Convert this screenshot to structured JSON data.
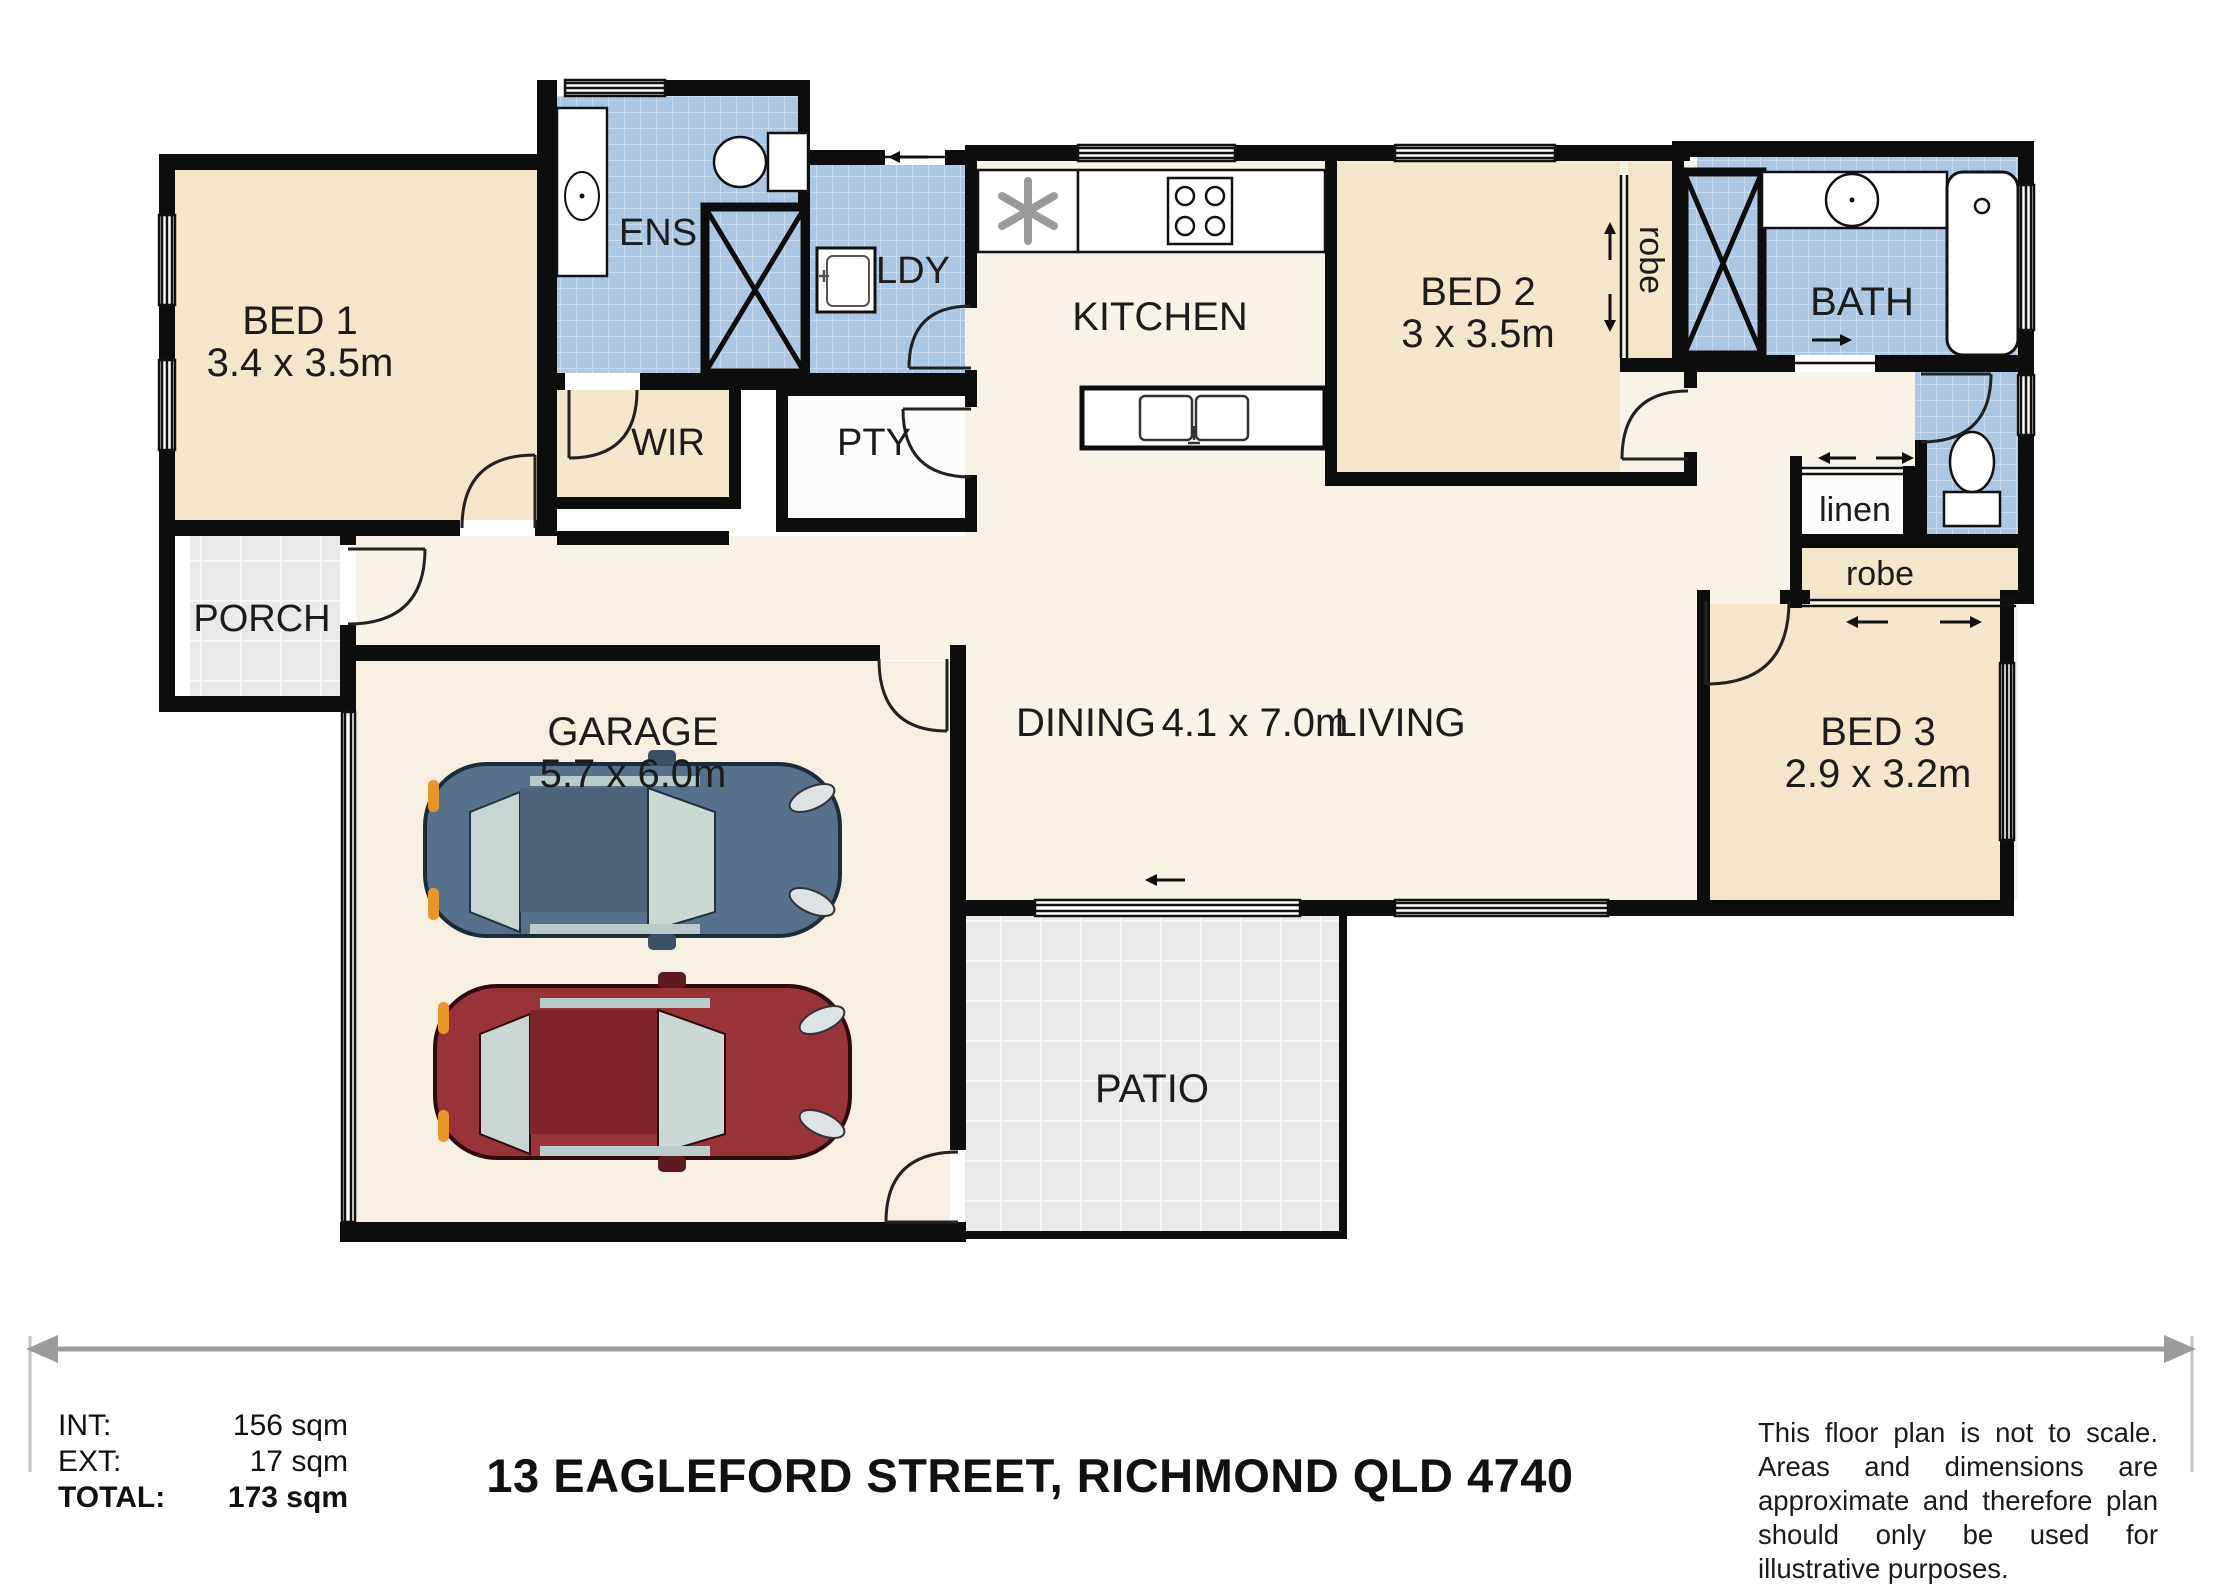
{
  "plan": {
    "rooms": {
      "bed1": {
        "name": "BED 1",
        "dims": "3.4 x 3.5m"
      },
      "ens": {
        "name": "ENS"
      },
      "ldy": {
        "name": "LDY"
      },
      "wir": {
        "name": "WIR"
      },
      "pty": {
        "name": "PTY"
      },
      "kitchen": {
        "name": "KITCHEN"
      },
      "bed2": {
        "name": "BED 2",
        "dims": "3 x 3.5m"
      },
      "robe_bed2": {
        "name": "robe"
      },
      "bath": {
        "name": "BATH"
      },
      "linen": {
        "name": "linen"
      },
      "robe_bed3": {
        "name": "robe"
      },
      "bed3": {
        "name": "BED 3",
        "dims": "2.9 x 3.2m"
      },
      "dining": {
        "name": "DINING"
      },
      "living": {
        "name": "LIVING"
      },
      "living_dining_dims": "4.1 x 7.0m",
      "garage": {
        "name": "GARAGE",
        "dims": "5.7 x 6.0m"
      },
      "porch": {
        "name": "PORCH"
      },
      "patio": {
        "name": "PATIO"
      }
    },
    "fixtures": [
      "shower-icon",
      "toilet-icon",
      "vanity-basin-icon",
      "bathtub-icon",
      "laundry-tub-icon",
      "cooktop-icon",
      "double-sink-icon",
      "ceiling-fan-icon",
      "car-blue-icon",
      "car-red-icon"
    ],
    "colors": {
      "wall": "#0d0d0d",
      "beige": "#f3e6ca",
      "cream": "#f8f2e7",
      "garage_floor": "#f6efe2",
      "tile_blue": "#abc7e3",
      "tile_gray": "#e9e9e9",
      "accent_orange": "#e8952c"
    }
  },
  "footer": {
    "areas": [
      {
        "label": "INT:",
        "value": "156 sqm"
      },
      {
        "label": "EXT:",
        "value": "17 sqm"
      },
      {
        "label": "TOTAL:",
        "value": "173 sqm"
      }
    ],
    "address": "13 EAGLEFORD STREET, RICHMOND QLD 4740",
    "disclaimer": "This floor plan is not to scale. Areas and dimensions are approximate and therefore plan should only be used for illustrative purposes."
  }
}
